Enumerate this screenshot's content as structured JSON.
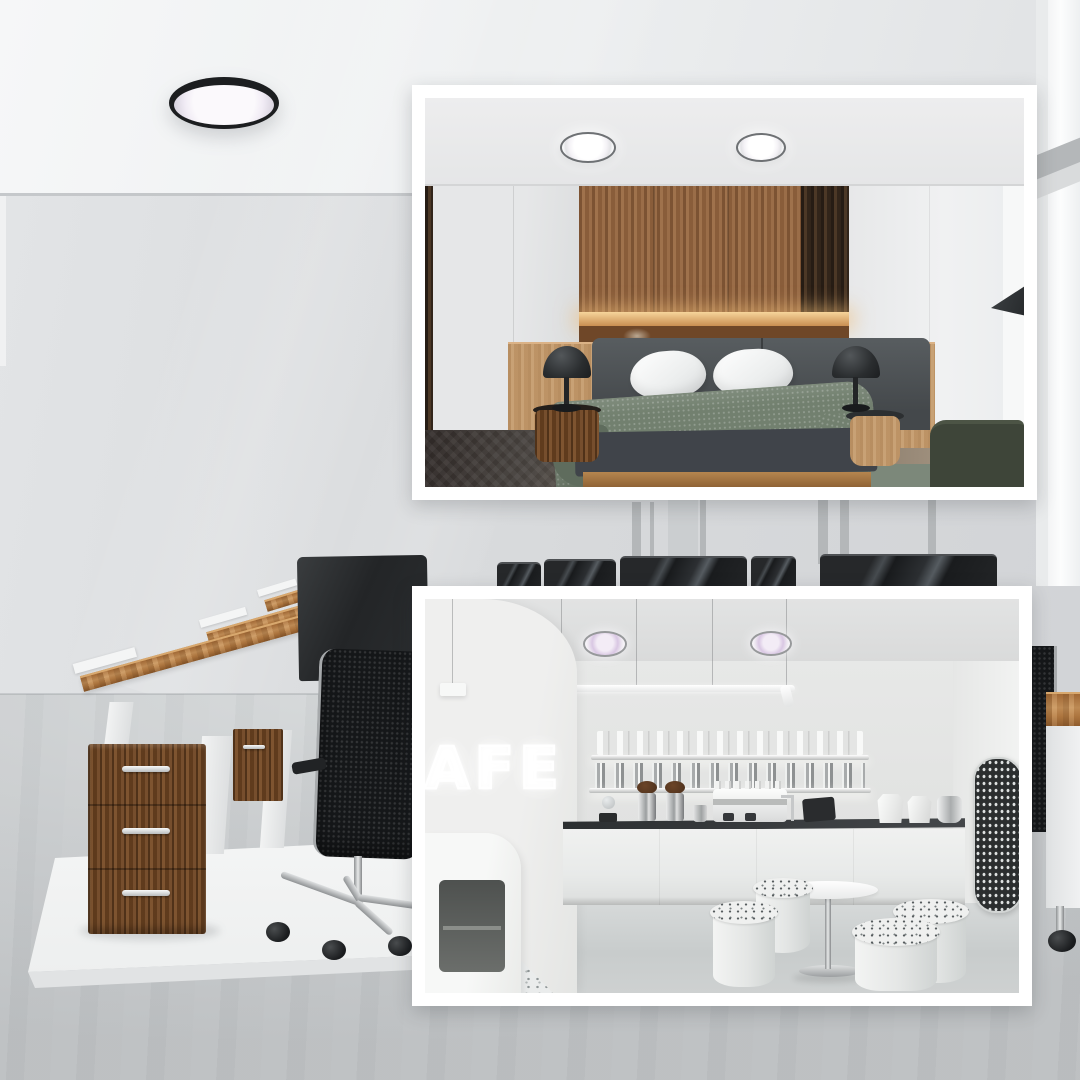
{
  "page": {
    "type": "lifestyle product collage",
    "subject": "slim round ceiling lamp shown in office, bedroom and cafe interiors"
  },
  "colors": {
    "frame": "#ffffff",
    "office_wall": "#d7d9db",
    "office_floor": "#c8cbcd",
    "desk_wood": "#b0773f",
    "drawer_walnut": "#6f4522",
    "lamp_rim": "#1c1e20",
    "lamp_face": "#f2edf6",
    "bedroom_wood": "#946540",
    "blanket_green": "#72806f",
    "cafe_lamp_face": "#d9c7e3"
  },
  "office_scene": {
    "label": "open office with wooden desks, black chairs and round black ceiling lamp",
    "ceiling_lamps": 1
  },
  "bedroom_scene": {
    "label": "bedroom inset with wood paneling, bed and two slim ceiling lamps",
    "ceiling_lamps": 2
  },
  "cafe_scene": {
    "label": "cafe inset with counter, stools and two slim ceiling lamps",
    "ceiling_lamps": 2,
    "neon_sign": "CAFE"
  }
}
